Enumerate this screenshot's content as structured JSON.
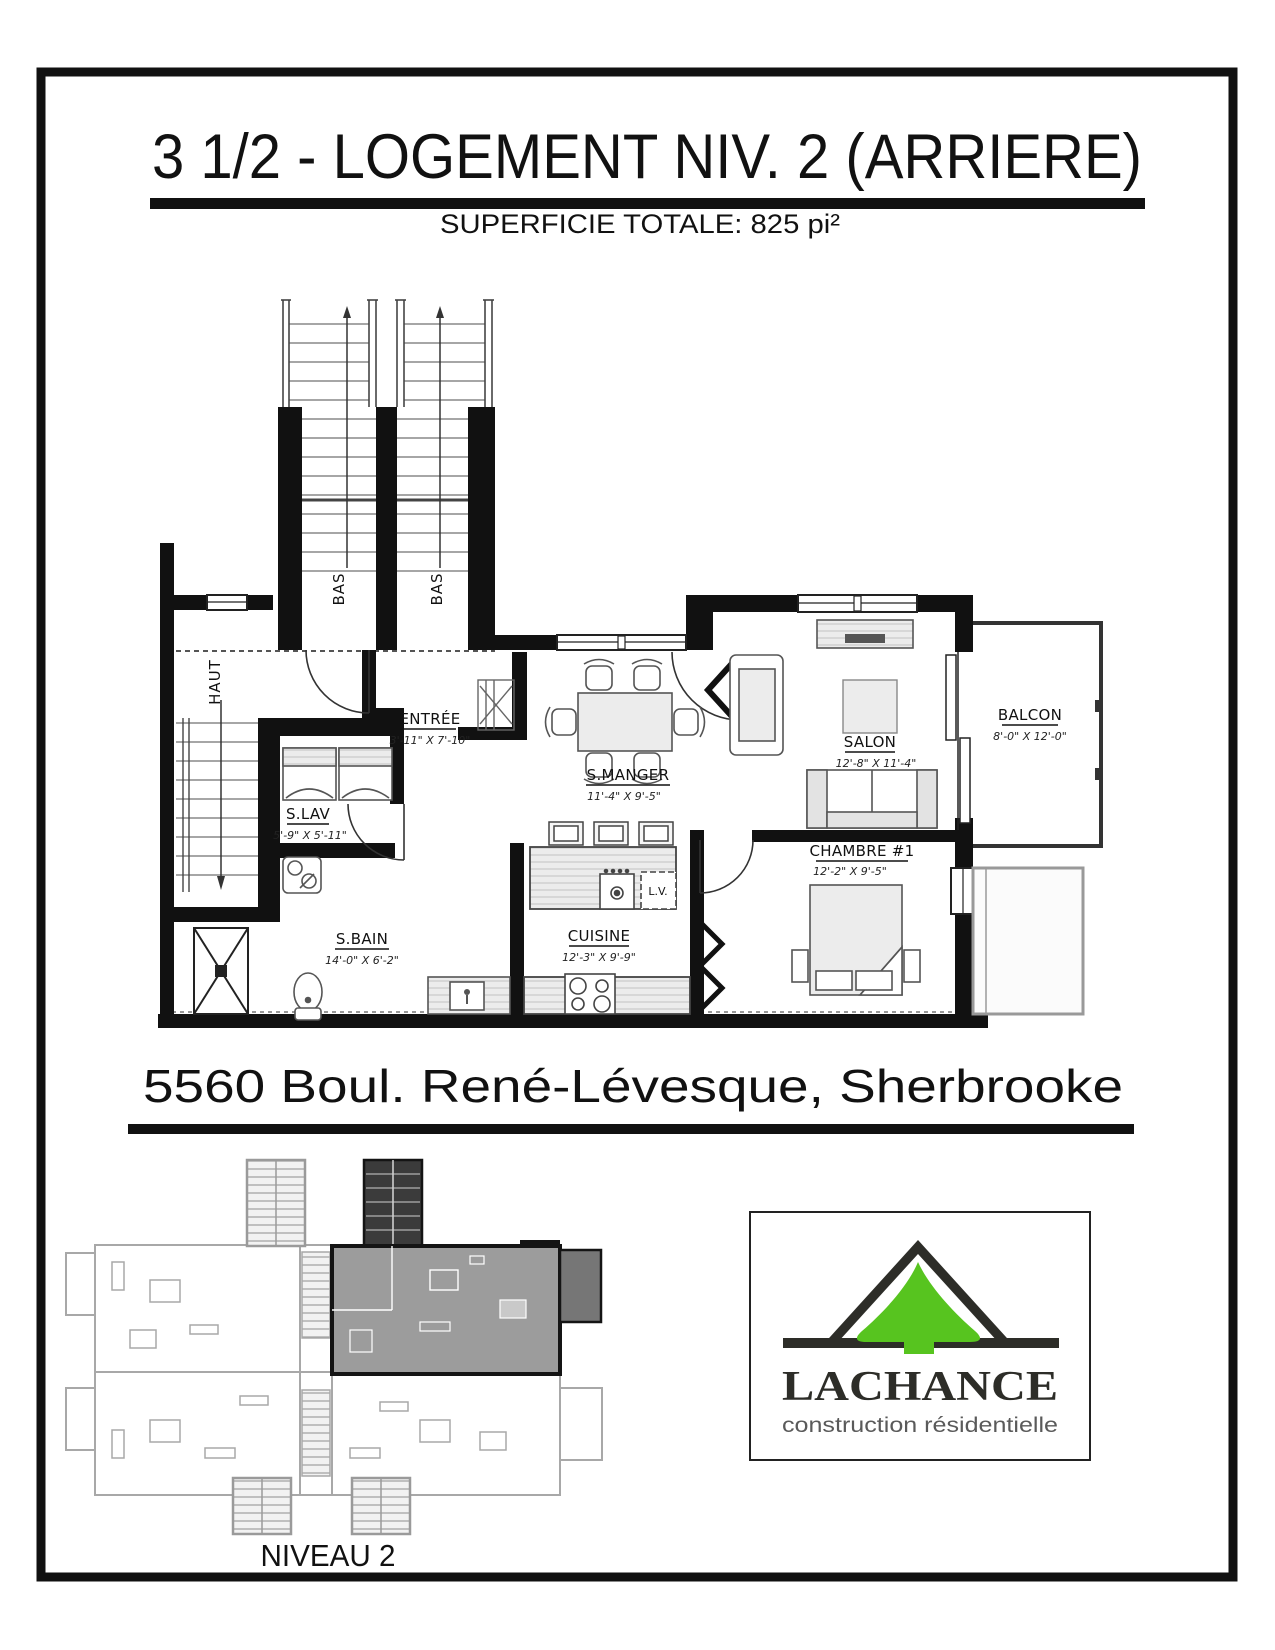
{
  "page": {
    "title": "3 1/2 - LOGEMENT NIV. 2 (ARRIERE)",
    "subtitle": "SUPERFICIE TOTALE: 825 pi²",
    "address": "5560 Boul. René-Lévesque, Sherbrooke",
    "overview_label": "NIVEAU 2"
  },
  "floorplan": {
    "stair_left_label": "BAS",
    "stair_right_label": "BAS",
    "stair_unit_label": "HAUT",
    "dishwasher_label": "L.V.",
    "rooms": {
      "entree": {
        "name": "ENTRÉE",
        "dims": "3'-11\" X 7'-10\""
      },
      "slav": {
        "name": "S.LAV",
        "dims": "5'-9\" X 5'-11\""
      },
      "sbain": {
        "name": "S.BAIN",
        "dims": "14'-0\" X 6'-2\""
      },
      "cuisine": {
        "name": "CUISINE",
        "dims": "12'-3\" X 9'-9\""
      },
      "smanger": {
        "name": "S.MANGER",
        "dims": "11'-4\" X 9'-5\""
      },
      "salon": {
        "name": "SALON",
        "dims": "12'-8\" X 11'-4\""
      },
      "chambre": {
        "name": "CHAMBRE #1",
        "dims": "12'-2\" X 9'-5\""
      },
      "balcon": {
        "name": "BALCON",
        "dims": "8'-0\" X 12'-0\""
      }
    }
  },
  "logo": {
    "name": "LACHANCE",
    "tagline": "construction résidentielle",
    "icon": "roof-tree-logo",
    "colors": {
      "green": "#57c41f",
      "dark": "#2d2d28",
      "tagline_gray": "#5a5a5a"
    }
  }
}
